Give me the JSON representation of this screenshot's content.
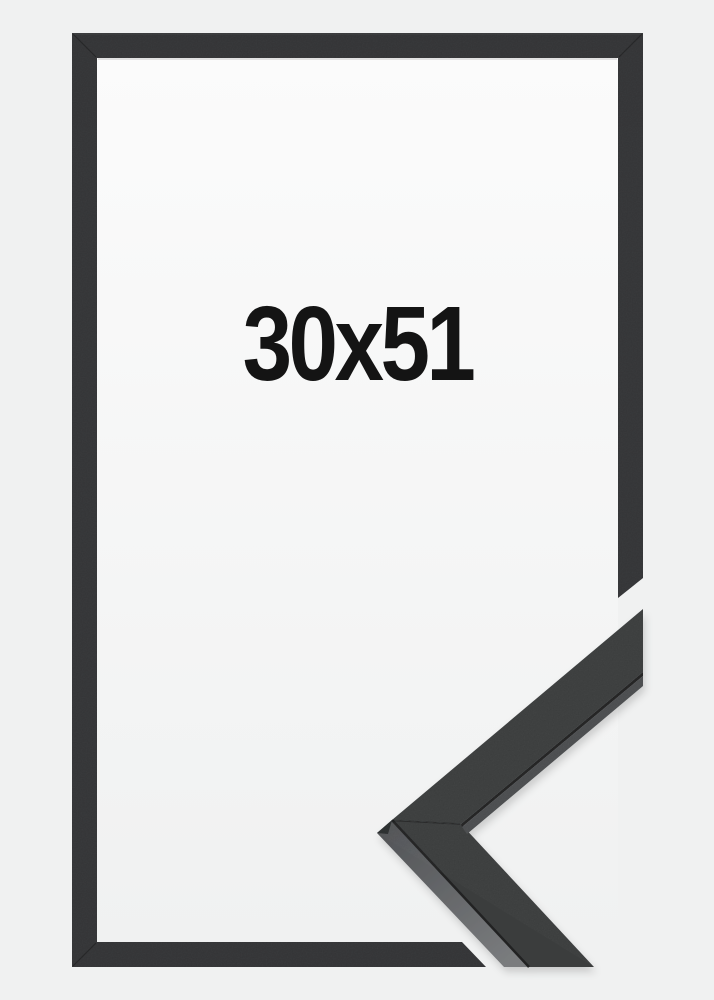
{
  "product": {
    "size_label": "30x51"
  },
  "colors": {
    "background": "#f0f1f1",
    "backing_top": "#fbfbfb",
    "backing_bottom": "#f0f1f1",
    "frame": "#333436",
    "frame_edge_highlight": "#4a4c4d",
    "sample_face": "#3b3d3e",
    "sample_side_mid": "#4b4d4f",
    "sample_side_light_top": "#515356",
    "sample_side_light_bottom": "#7a7c7e",
    "sample_facet": "#2b2d2f",
    "crease": "#202224",
    "label_text": "#141414"
  }
}
